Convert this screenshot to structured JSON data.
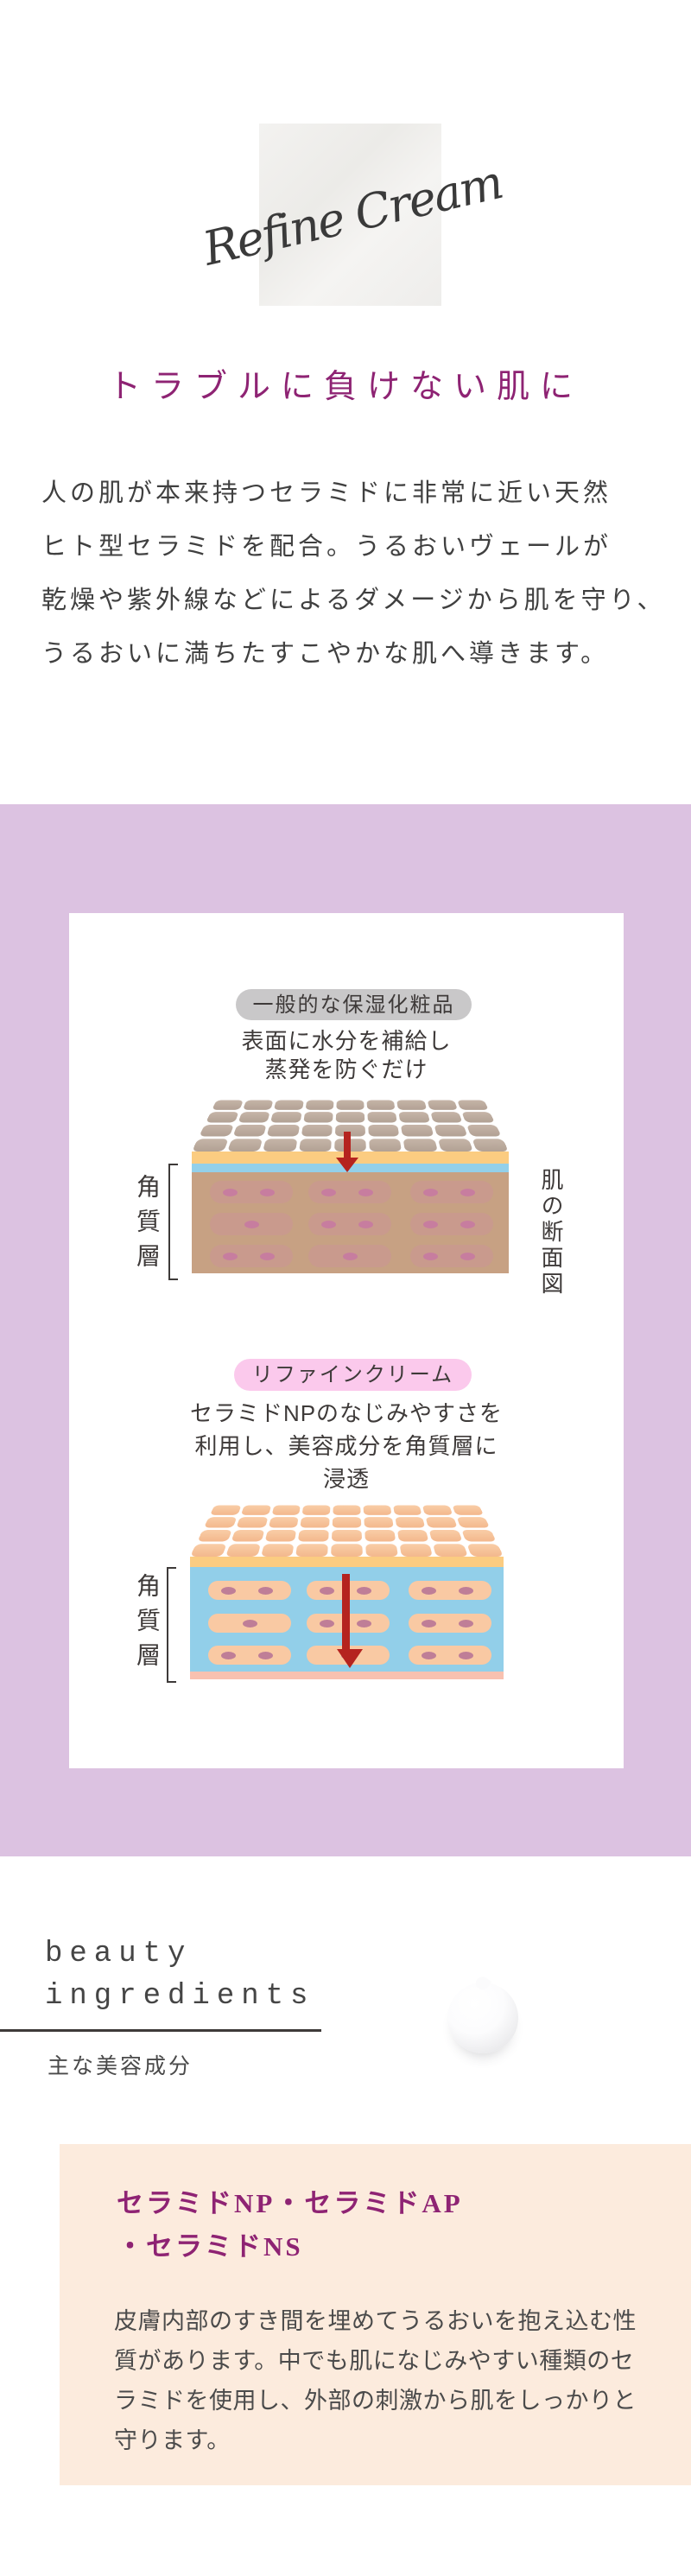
{
  "logo": {
    "text": "Refine Cream"
  },
  "hero": {
    "heading": "トラブルに負けない肌に",
    "paragraph_lines": [
      "人の肌が本来持つセラミドに非常に近い天然",
      "ヒト型セラミドを配合。うるおいヴェールが",
      "乾燥や紫外線などによるダメージから肌を守り、",
      "うるおいに満ちたすこやかな肌へ導きます。"
    ]
  },
  "comparison": {
    "general": {
      "badge": "一般的な保湿化粧品",
      "caption_lines": [
        "表面に水分を補給し",
        "蒸発を防ぐだけ"
      ],
      "left_label": "角質層",
      "right_label": "肌の断面図",
      "cells_ovals": [
        [
          2,
          2,
          2
        ],
        [
          1,
          2,
          2
        ],
        [
          2,
          1,
          2
        ]
      ]
    },
    "refine": {
      "badge": "リファインクリーム",
      "caption_lines": [
        "セラミドNPのなじみやすさを",
        "利用し、美容成分を角質層に",
        "浸透"
      ],
      "left_label": "角質層",
      "cells_ovals": [
        [
          2,
          2,
          2
        ],
        [
          1,
          2,
          2
        ],
        [
          2,
          1,
          2
        ]
      ]
    }
  },
  "ingredients": {
    "title_line1": "beauty",
    "title_line2": "ingredients",
    "subtitle": "主な美容成分",
    "item": {
      "heading_line1": "セラミドNP・セラミドAP",
      "heading_line2": "・セラミドNS",
      "body_lines": [
        "皮膚内部のすき間を埋めてうるおいを抱え込む性",
        "質があります。中でも肌になじみやすい種類のセ",
        "ラミドを使用し、外部の刺激から肌をしっかりと",
        "守ります。"
      ]
    }
  },
  "colors": {
    "accent_magenta": "#8e2373",
    "purple_band": "#dcc2e1",
    "pill_gray": "#c9c8c9",
    "pill_pink": "#fbc9ec",
    "water_blue": "#93d0ea",
    "veil_yellow": "#fbcc81",
    "skin_tan": "#c7a183",
    "skin_peach": "#f9c9a3",
    "arrow_red": "#b5231f",
    "ingredient_box": "#fcebdd"
  }
}
